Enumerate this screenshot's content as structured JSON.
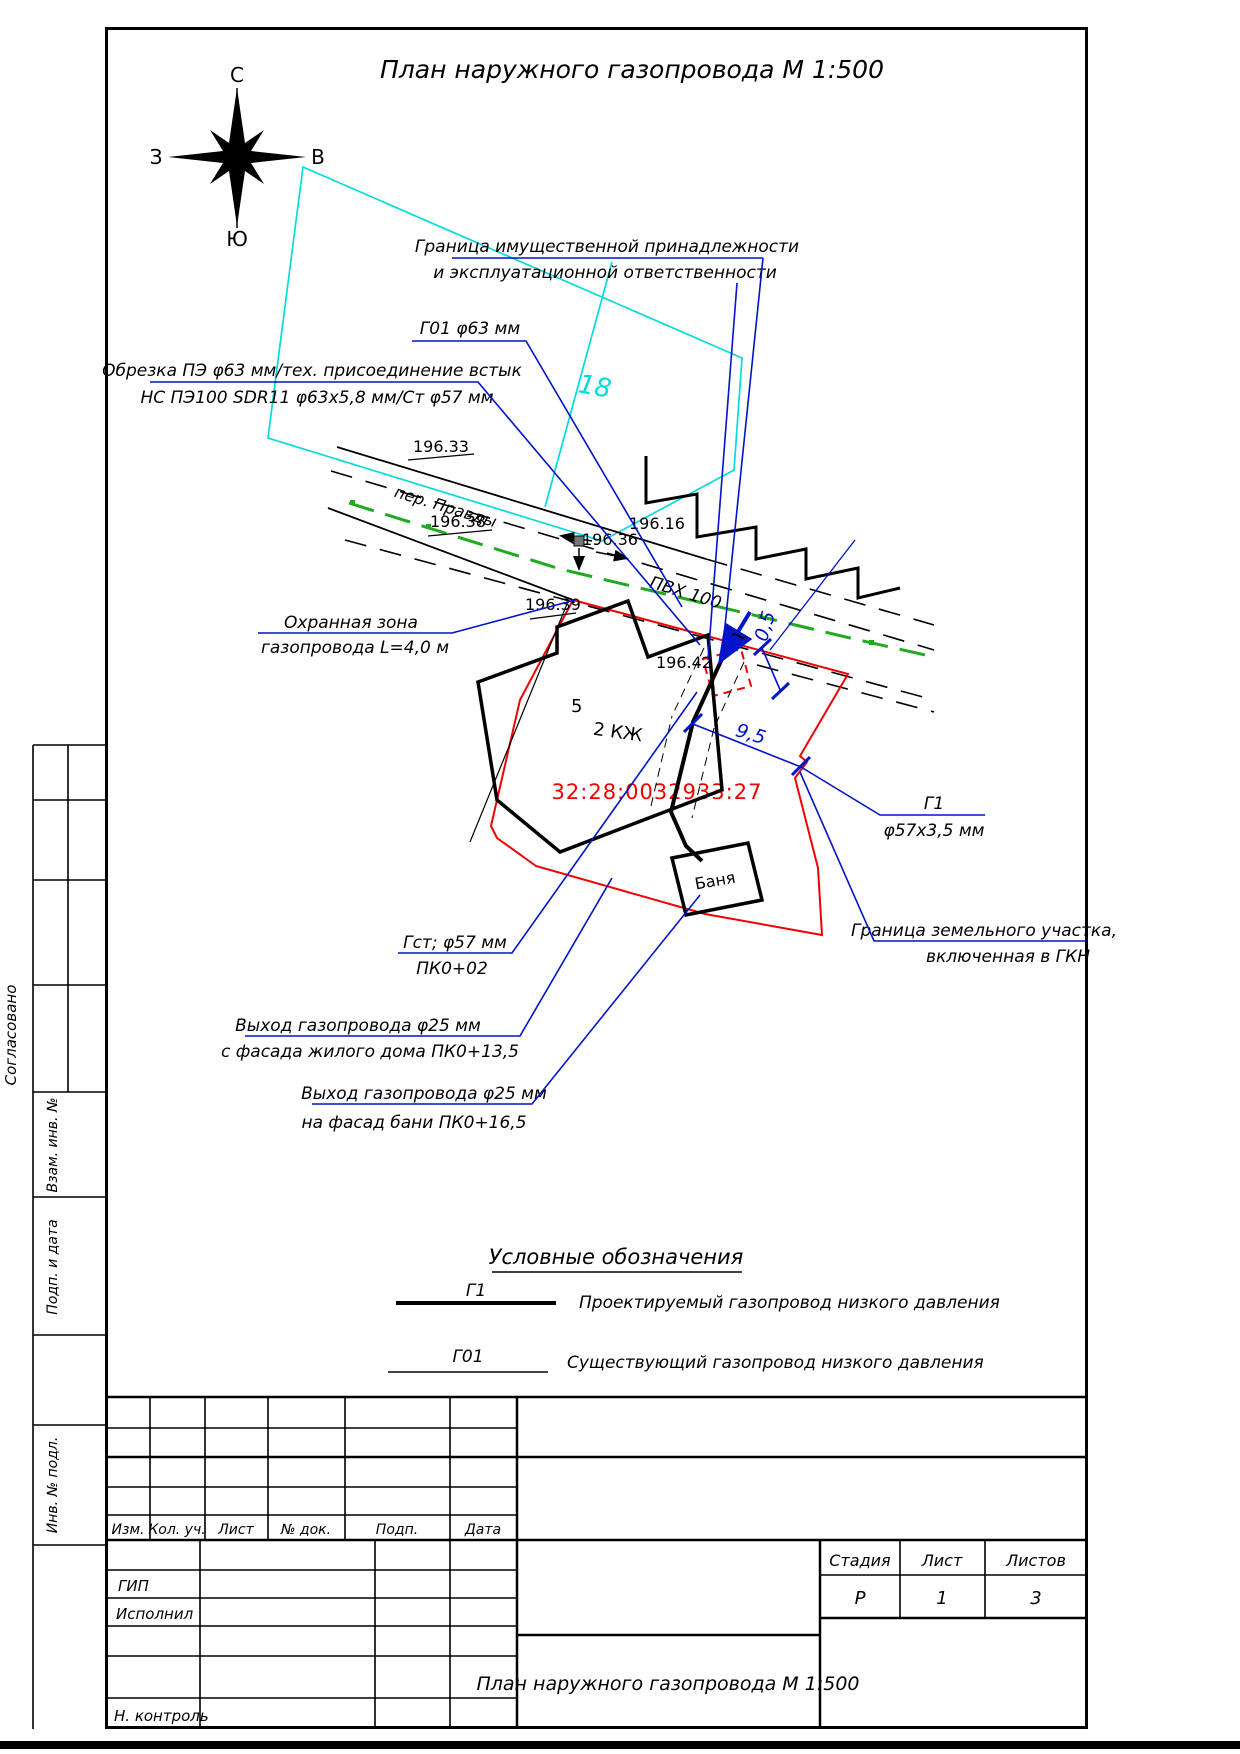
{
  "title": "План наружного газопровода  М 1:500",
  "compass": {
    "n": "С",
    "s": "Ю",
    "w": "З",
    "e": "В"
  },
  "map": {
    "neighbor_parcel": "18",
    "street": "пер. Правды",
    "existing_pipe": "ПВХ 100",
    "cadastral": "32:28:0032933:27",
    "house_no": "5",
    "house": "2 КЖ",
    "bath": "Баня",
    "elev1": "196.33",
    "elev2": "196.38",
    "elev3": "196.36",
    "elev4": "196.16",
    "elev5": "196.39",
    "elev6": "196.42",
    "dim05": "0,5",
    "dim95": "9,5",
    "tilde": "~"
  },
  "ann": {
    "own1": "Граница имущественной принадлежности",
    "own2": "и эксплуатационной ответственности",
    "g01": "Г01 φ63 мм",
    "cut1": "Обрезка ПЭ φ63 мм/тех. присоединение встык",
    "cut2": "НС ПЭ100 SDR11 φ63х5,8 мм/Ст φ57 мм",
    "guard1": "Охранная зона",
    "guard2": "газопровода L=4,0 м",
    "g1a": "Г1",
    "g1b": "φ57х3,5 мм",
    "gst1": "Гст; φ57 мм",
    "gst2": "ПК0+02",
    "exit1a": "Выход газопровода φ25 мм",
    "exit1b": "с фасада жилого дома ПК0+13,5",
    "exit2a": "Выход газопровода φ25 мм",
    "exit2b": "на фасад бани ПК0+16,5",
    "bnd1": "Граница земельного участка,",
    "bnd2": "включенная в ГКН"
  },
  "legend": {
    "heading": "Условные обозначения",
    "items": [
      {
        "label": "Г1",
        "text": "Проектируемый газопровод низкого давления"
      },
      {
        "label": "Г01",
        "text": "Существующий газопровод низкого давления"
      }
    ]
  },
  "sidebar": {
    "agreed": "Согласовано",
    "vzam": "Взам. инв. №",
    "podp": "Подп. и дата",
    "inv": "Инв. № подл."
  },
  "tb": {
    "rev": [
      "Изм.",
      "Кол. уч.",
      "Лист",
      "№ док.",
      "Подп.",
      "Дата"
    ],
    "gip": "ГИП",
    "exec": "Исполнил",
    "ncontrol": "Н. контроль",
    "stage_h": "Стадия",
    "sheet_h": "Лист",
    "sheets_h": "Листов",
    "stage": "Р",
    "sheet": "1",
    "sheets": "3",
    "doc": "План наружного газопровода М 1:500"
  },
  "colors": {
    "blue": "#0014c8",
    "cyan": "#00dcdc",
    "green": "#1faa1f",
    "red": "#f00000"
  }
}
